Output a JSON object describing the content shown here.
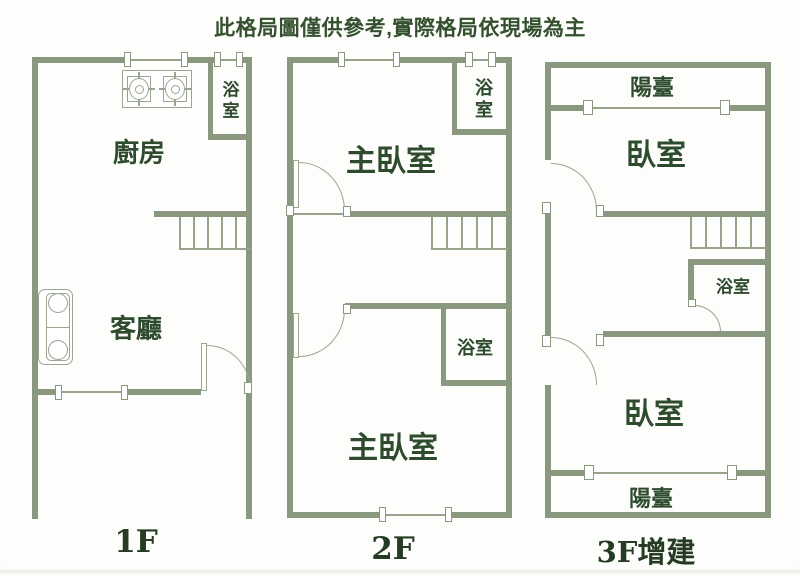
{
  "title": "此格局圖僅供參考,實際格局依現場為主",
  "colors": {
    "wall": "#8a9880",
    "line": "#97a38b",
    "icon": "#9aa690",
    "room_text": "#2e4b2e",
    "title_text": "#35502f",
    "floor_text": "#253c22",
    "background": "#fdfdfb"
  },
  "icons": {
    "stove": "stove-icon",
    "sofa": "sofa-icon",
    "stairs": "stairs-icon",
    "door": "door-swing-icon",
    "window": "window-icon"
  },
  "floors": [
    {
      "label": "1F",
      "rooms": {
        "kitchen": "廚房",
        "living_room": "客廳",
        "bathroom": "浴室"
      }
    },
    {
      "label": "2F",
      "rooms": {
        "master_bedroom_top": "主臥室",
        "bathroom_top": "浴室",
        "bathroom_bottom": "浴室",
        "master_bedroom_bottom": "主臥室"
      }
    },
    {
      "label": "3F增建",
      "rooms": {
        "balcony_top": "陽臺",
        "bedroom_top": "臥室",
        "bathroom": "浴室",
        "bedroom_bottom": "臥室",
        "balcony_bottom": "陽臺"
      }
    }
  ]
}
